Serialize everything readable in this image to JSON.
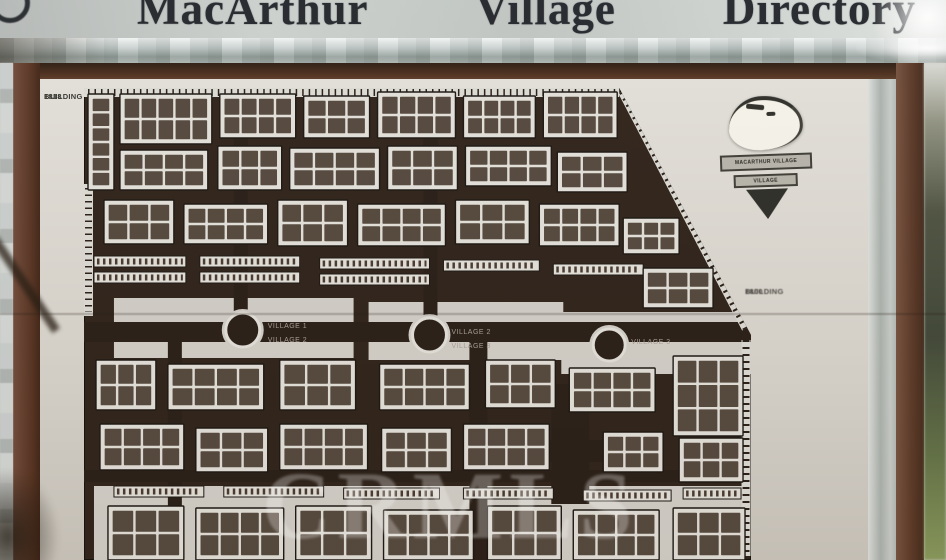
{
  "title": {
    "words": [
      "MacArthur",
      "Village",
      "Directory"
    ]
  },
  "side_labels": {
    "b1818": {
      "line1": "1818",
      "line2": "BUILDING"
    },
    "b1800": {
      "line1": "1800",
      "line2": "BUILDING"
    }
  },
  "logo": {
    "banner1": "MACARTHUR VILLAGE",
    "banner2": "VILLAGE"
  },
  "watermark": "CRMLS",
  "map": {
    "colors": {
      "bg": "#2a1e16",
      "building": "#e4e2dc",
      "unit": "#44372d",
      "outline": "#17120e",
      "plaza": "#d3d0c9",
      "road": "#241a13",
      "stall": "#dddcd6",
      "label": "#a89f95"
    },
    "outline_pts": "0,0 536,0 668,247 668,472 0,472",
    "plazas": [
      [
        30,
        210,
        240,
        60
      ],
      [
        285,
        214,
        195,
        58
      ],
      [
        478,
        224,
        190,
        62
      ],
      [
        10,
        398,
        650,
        74
      ]
    ],
    "roads": [
      [
        0,
        234,
        675,
        20
      ],
      [
        150,
        0,
        14,
        234
      ],
      [
        340,
        0,
        14,
        240
      ],
      [
        386,
        254,
        18,
        218
      ],
      [
        468,
        296,
        38,
        120
      ],
      [
        440,
        352,
        124,
        22
      ],
      [
        84,
        254,
        14,
        218
      ],
      [
        0,
        382,
        660,
        12
      ]
    ],
    "strips": [
      [
        10,
        168,
        92,
        11
      ],
      [
        10,
        184,
        92,
        11
      ],
      [
        116,
        168,
        100,
        11
      ],
      [
        116,
        184,
        100,
        11
      ],
      [
        236,
        170,
        110,
        11
      ],
      [
        236,
        186,
        110,
        11
      ],
      [
        360,
        172,
        96,
        11
      ],
      [
        470,
        176,
        90,
        11
      ],
      [
        30,
        398,
        90,
        11
      ],
      [
        140,
        398,
        100,
        11
      ],
      [
        260,
        400,
        96,
        11
      ],
      [
        380,
        400,
        90,
        11
      ],
      [
        500,
        402,
        88,
        11
      ],
      [
        600,
        400,
        58,
        11
      ]
    ],
    "clusters": [
      [
        4,
        6,
        26,
        96,
        6,
        1
      ],
      [
        36,
        6,
        92,
        50,
        2,
        5
      ],
      [
        136,
        6,
        76,
        44,
        2,
        4
      ],
      [
        220,
        8,
        66,
        42,
        2,
        3
      ],
      [
        294,
        4,
        78,
        46,
        2,
        4
      ],
      [
        380,
        8,
        72,
        42,
        2,
        4
      ],
      [
        460,
        4,
        74,
        46,
        2,
        4
      ],
      [
        36,
        62,
        88,
        40,
        2,
        4
      ],
      [
        134,
        58,
        64,
        44,
        2,
        3
      ],
      [
        206,
        60,
        90,
        42,
        2,
        4
      ],
      [
        304,
        58,
        70,
        44,
        2,
        3
      ],
      [
        382,
        58,
        86,
        40,
        2,
        4
      ],
      [
        474,
        64,
        70,
        40,
        2,
        3
      ],
      [
        20,
        112,
        70,
        44,
        2,
        3
      ],
      [
        100,
        116,
        84,
        40,
        2,
        4
      ],
      [
        194,
        112,
        70,
        46,
        2,
        3
      ],
      [
        274,
        116,
        88,
        42,
        2,
        4
      ],
      [
        372,
        112,
        74,
        44,
        2,
        3
      ],
      [
        456,
        116,
        80,
        42,
        2,
        4
      ],
      [
        540,
        130,
        56,
        36,
        2,
        3
      ],
      [
        560,
        180,
        70,
        40,
        2,
        3
      ],
      [
        12,
        272,
        60,
        50,
        2,
        3
      ],
      [
        84,
        276,
        96,
        46,
        2,
        4
      ],
      [
        196,
        272,
        76,
        50,
        2,
        3
      ],
      [
        296,
        276,
        90,
        46,
        2,
        4
      ],
      [
        402,
        272,
        70,
        48,
        2,
        3
      ],
      [
        486,
        280,
        86,
        44,
        2,
        4
      ],
      [
        590,
        268,
        70,
        80,
        3,
        3
      ],
      [
        16,
        336,
        84,
        46,
        2,
        4
      ],
      [
        112,
        340,
        72,
        44,
        2,
        3
      ],
      [
        196,
        336,
        88,
        46,
        2,
        4
      ],
      [
        298,
        340,
        70,
        44,
        2,
        3
      ],
      [
        380,
        336,
        86,
        46,
        2,
        4
      ],
      [
        520,
        344,
        60,
        40,
        2,
        3
      ],
      [
        596,
        350,
        64,
        44,
        2,
        3
      ],
      [
        24,
        418,
        76,
        54,
        2,
        3
      ],
      [
        112,
        420,
        88,
        52,
        2,
        4
      ],
      [
        212,
        418,
        76,
        54,
        2,
        3
      ],
      [
        300,
        422,
        90,
        50,
        2,
        4
      ],
      [
        404,
        418,
        74,
        54,
        2,
        3
      ],
      [
        490,
        422,
        86,
        50,
        2,
        4
      ],
      [
        590,
        420,
        72,
        52,
        2,
        3
      ]
    ],
    "circles": [
      [
        159,
        242,
        17
      ],
      [
        346,
        247,
        17
      ],
      [
        526,
        257,
        16
      ]
    ],
    "labels": [
      {
        "text": "VILLAGE 1",
        "x": 184,
        "y": 240
      },
      {
        "text": "VILLAGE 2",
        "x": 184,
        "y": 254
      },
      {
        "text": "VILLAGE 2",
        "x": 368,
        "y": 246
      },
      {
        "text": "VILLAGE 3",
        "x": 368,
        "y": 260
      },
      {
        "text": "VILLAGE 3",
        "x": 548,
        "y": 256
      }
    ]
  }
}
